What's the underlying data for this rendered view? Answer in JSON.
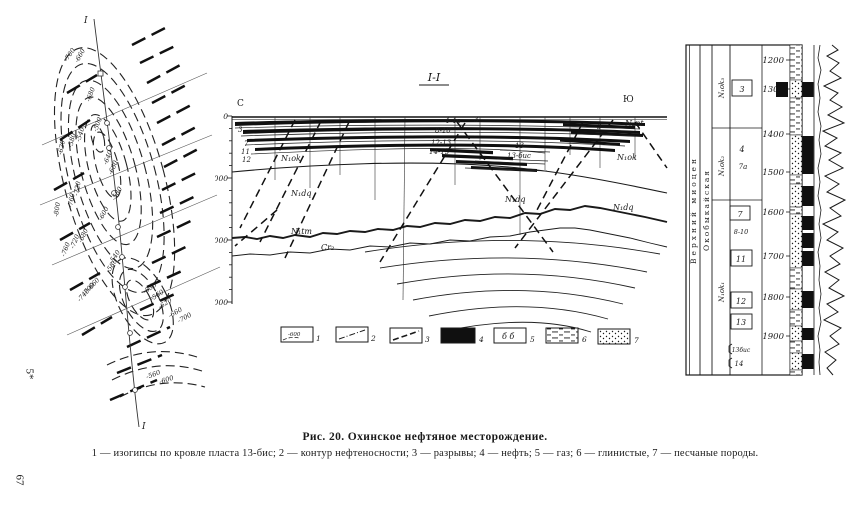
{
  "page": {
    "signature": "5*",
    "page_number": "67"
  },
  "caption": {
    "title": "Рис. 20. Охинское нефтяное месторождение.",
    "legend_line": "1 — изогипсы по кровле пласта 13-бис; 2 — контур нефтеносности; 3 — разрывы; 4 — нефть; 5 — газ; 6 — глинистые, 7 — песчаные породы."
  },
  "map": {
    "section_label_top": "I",
    "section_label_bottom": "I",
    "contour_labels": [
      "-700",
      "-660",
      "-680",
      "-620",
      "-580",
      "-540",
      "-500",
      "-640",
      "-680",
      "-720",
      "-760",
      "-800",
      "-580",
      "-600",
      "-680",
      "-720",
      "-760",
      "-540",
      "-580",
      "-660",
      "-700",
      "-740",
      "-530",
      "-560",
      "-620",
      "-660",
      "-700",
      "-560",
      "-600"
    ]
  },
  "section": {
    "title": "I-I",
    "north": "С",
    "south": "Ю",
    "depth_labels": [
      "0",
      "1000",
      "2000",
      "3000"
    ],
    "left_bed_labels": [
      "3",
      "7",
      "11",
      "12"
    ],
    "center_bed_labels": [
      "4-4а",
      "3",
      "8-10",
      "12-13",
      "14-15",
      "13",
      "13-бис",
      "3"
    ],
    "strata": {
      "n2nt": "N₂nt",
      "n1ok_left": "N₁ok",
      "n1ok_right": "N₁ok",
      "n1dq_left": "N₁dq",
      "n1dq_center": "N₁dq",
      "n1dq_right": "N₁dq",
      "n1tm": "N₁tm",
      "cr2": "Cr₂"
    },
    "legend_items": [
      {
        "num": "1",
        "box_text": "-600"
      },
      {
        "num": "2",
        "box_text": ""
      },
      {
        "num": "3",
        "box_text": ""
      },
      {
        "num": "4",
        "box_text": ""
      },
      {
        "num": "5",
        "box_text": "б б"
      },
      {
        "num": "6",
        "box_text": ""
      },
      {
        "num": "7",
        "box_text": ""
      }
    ]
  },
  "column": {
    "stage_label": "Верхний миоцен",
    "suite_label": "Окобыкайская",
    "units": [
      "N₁ok₃",
      "N₁ok₂",
      "N₁ok₁"
    ],
    "beds": [
      "3",
      "4",
      "7а",
      "7",
      "8-10",
      "11",
      "12",
      "13",
      "13бис",
      "14"
    ],
    "depths": [
      "1200",
      "1300",
      "1400",
      "1500",
      "1600",
      "1700",
      "1800",
      "1900"
    ]
  }
}
